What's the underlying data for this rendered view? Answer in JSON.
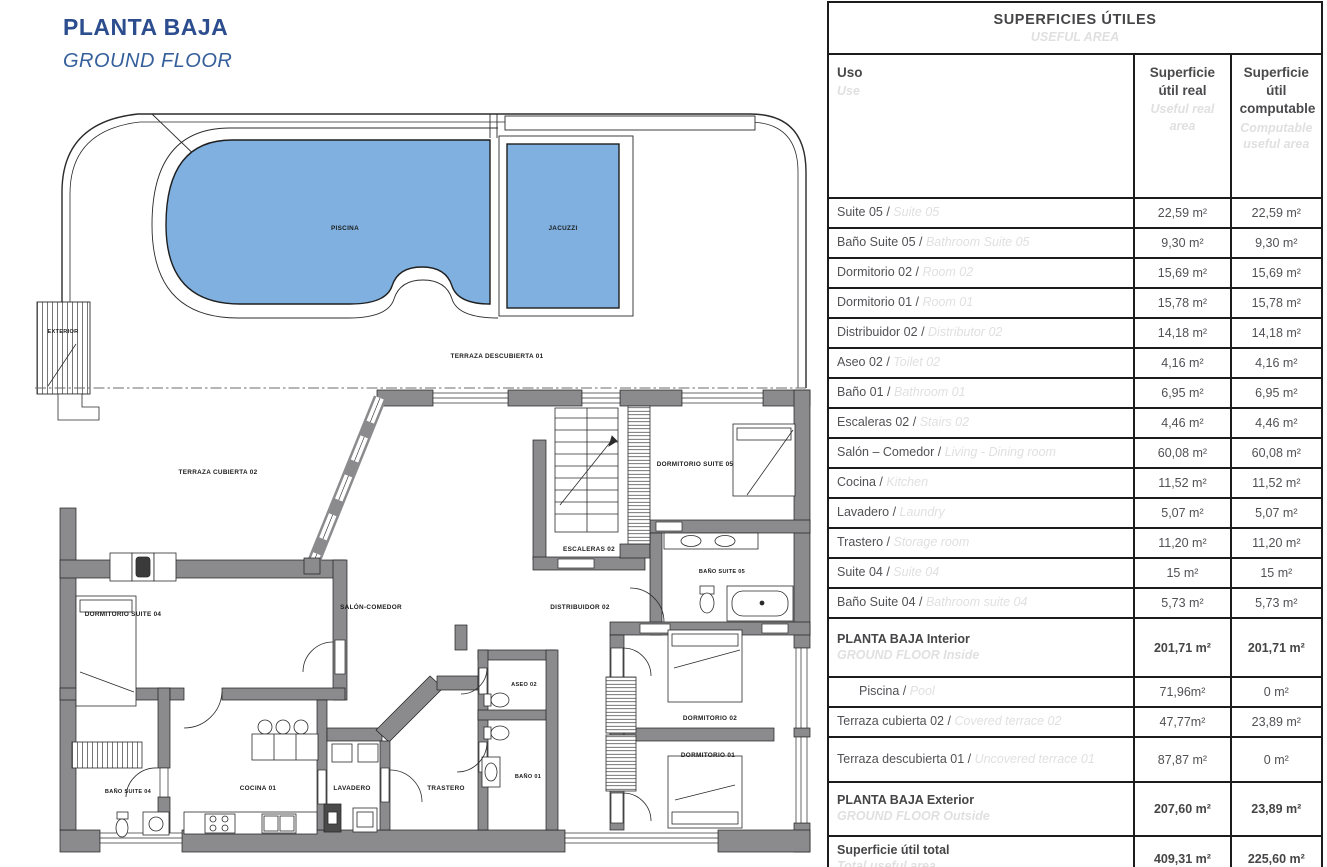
{
  "title": {
    "es": "PLANTA BAJA",
    "en": "GROUND FLOOR"
  },
  "colors": {
    "accent_navy": "#2c4d8e",
    "accent_blue_italic": "#35609c",
    "pool_blue": "#7fb0df",
    "wall_gray": "#8b8b8e",
    "table_text_dark": "#515155",
    "table_text_light": "#e0e0e0",
    "border_black": "#1c1c1c"
  },
  "plan": {
    "labels": {
      "piscina": "PISCINA",
      "jacuzzi": "JACUZZI",
      "terraza_descubierta": "TERRAZA DESCUBIERTA 01",
      "terraza_cubierta": "TERRAZA CUBIERTA 02",
      "exterior": "EXTERIOR",
      "dormitorio_suite_05": "DORMITORIO SUITE 05",
      "escaleras_02": "ESCALERAS 02",
      "bano_suite_05": "BAÑO SUITE 05",
      "distribuidor_02": "DISTRIBUIDOR 02",
      "salon_comedor": "SALÓN-COMEDOR",
      "dormitorio_suite_04": "DORMITORIO SUITE 04",
      "bano_suite_04": "BAÑO SUITE 04",
      "cocina_01": "COCINA 01",
      "lavadero": "LAVADERO",
      "trastero": "TRASTERO",
      "aseo_02": "ASEO 02",
      "bano_01": "BAÑO 01",
      "dormitorio_02": "DORMITORIO 02",
      "dormitorio_01": "DORMITORIO 01"
    }
  },
  "table": {
    "title_es": "SUPERFICIES ÚTILES",
    "title_en": "USEFUL AREA",
    "sep": " / ",
    "col_uso_es": "Uso",
    "col_uso_en": "Use",
    "col_real_es": "Superficie útil real",
    "col_real_en": "Useful real area",
    "col_comp_es": "Superficie útil computable",
    "col_comp_en": "Computable useful area",
    "rows": [
      {
        "es": "Suite 05",
        "en": "Suite 05",
        "real": "22,59 m²",
        "comp": "22,59 m²"
      },
      {
        "es": "Baño Suite 05",
        "en": "Bathroom Suite 05",
        "real": "9,30 m²",
        "comp": "9,30 m²"
      },
      {
        "es": "Dormitorio 02",
        "en": "Room 02",
        "real": "15,69 m²",
        "comp": "15,69 m²"
      },
      {
        "es": "Dormitorio 01",
        "en": "Room 01",
        "real": "15,78 m²",
        "comp": "15,78 m²"
      },
      {
        "es": "Distribuidor 02",
        "en": "Distributor 02",
        "real": "14,18 m²",
        "comp": "14,18 m²"
      },
      {
        "es": "Aseo 02",
        "en": "Toilet 02",
        "real": "4,16 m²",
        "comp": "4,16 m²"
      },
      {
        "es": "Baño 01",
        "en": "Bathroom 01",
        "real": "6,95 m²",
        "comp": "6,95 m²"
      },
      {
        "es": "Escaleras 02",
        "en": "Stairs 02",
        "real": "4,46 m²",
        "comp": "4,46 m²"
      },
      {
        "es": "Salón – Comedor",
        "en": "Living - Dining room",
        "real": "60,08 m²",
        "comp": "60,08 m²"
      },
      {
        "es": "Cocina",
        "en": "Kitchen",
        "real": "11,52 m²",
        "comp": "11,52 m²"
      },
      {
        "es": "Lavadero",
        "en": "Laundry",
        "real": "5,07 m²",
        "comp": "5,07 m²"
      },
      {
        "es": "Trastero",
        "en": "Storage room",
        "real": "11,20 m²",
        "comp": "11,20 m²"
      },
      {
        "es": "Suite 04",
        "en": "Suite 04",
        "real": "15 m²",
        "comp": "15 m²"
      },
      {
        "es": "Baño Suite 04",
        "en": "Bathroom suite 04",
        "real": "5,73 m²",
        "comp": "5,73 m²"
      },
      {
        "es": "PLANTA BAJA Interior",
        "en": "GROUND FLOOR Inside",
        "real": "201,71 m²",
        "comp": "201,71 m²"
      },
      {
        "es": "Piscina",
        "en": "Pool",
        "real": "71,96m²",
        "comp": "0 m²"
      },
      {
        "es": "Terraza cubierta 02",
        "en": "Covered terrace 02",
        "real": "47,77m²",
        "comp": "23,89 m²"
      },
      {
        "es": "Terraza descubierta 01",
        "en": "Uncovered terrace 01",
        "real": "87,87 m²",
        "comp": "0 m²"
      },
      {
        "es": "PLANTA BAJA Exterior",
        "en": "GROUND FLOOR Outside",
        "real": "207,60 m²",
        "comp": "23,89 m²"
      },
      {
        "es": "Superficie útil total",
        "en": "Total useful area",
        "real": "409,31 m²",
        "comp": "225,60 m²"
      }
    ]
  }
}
